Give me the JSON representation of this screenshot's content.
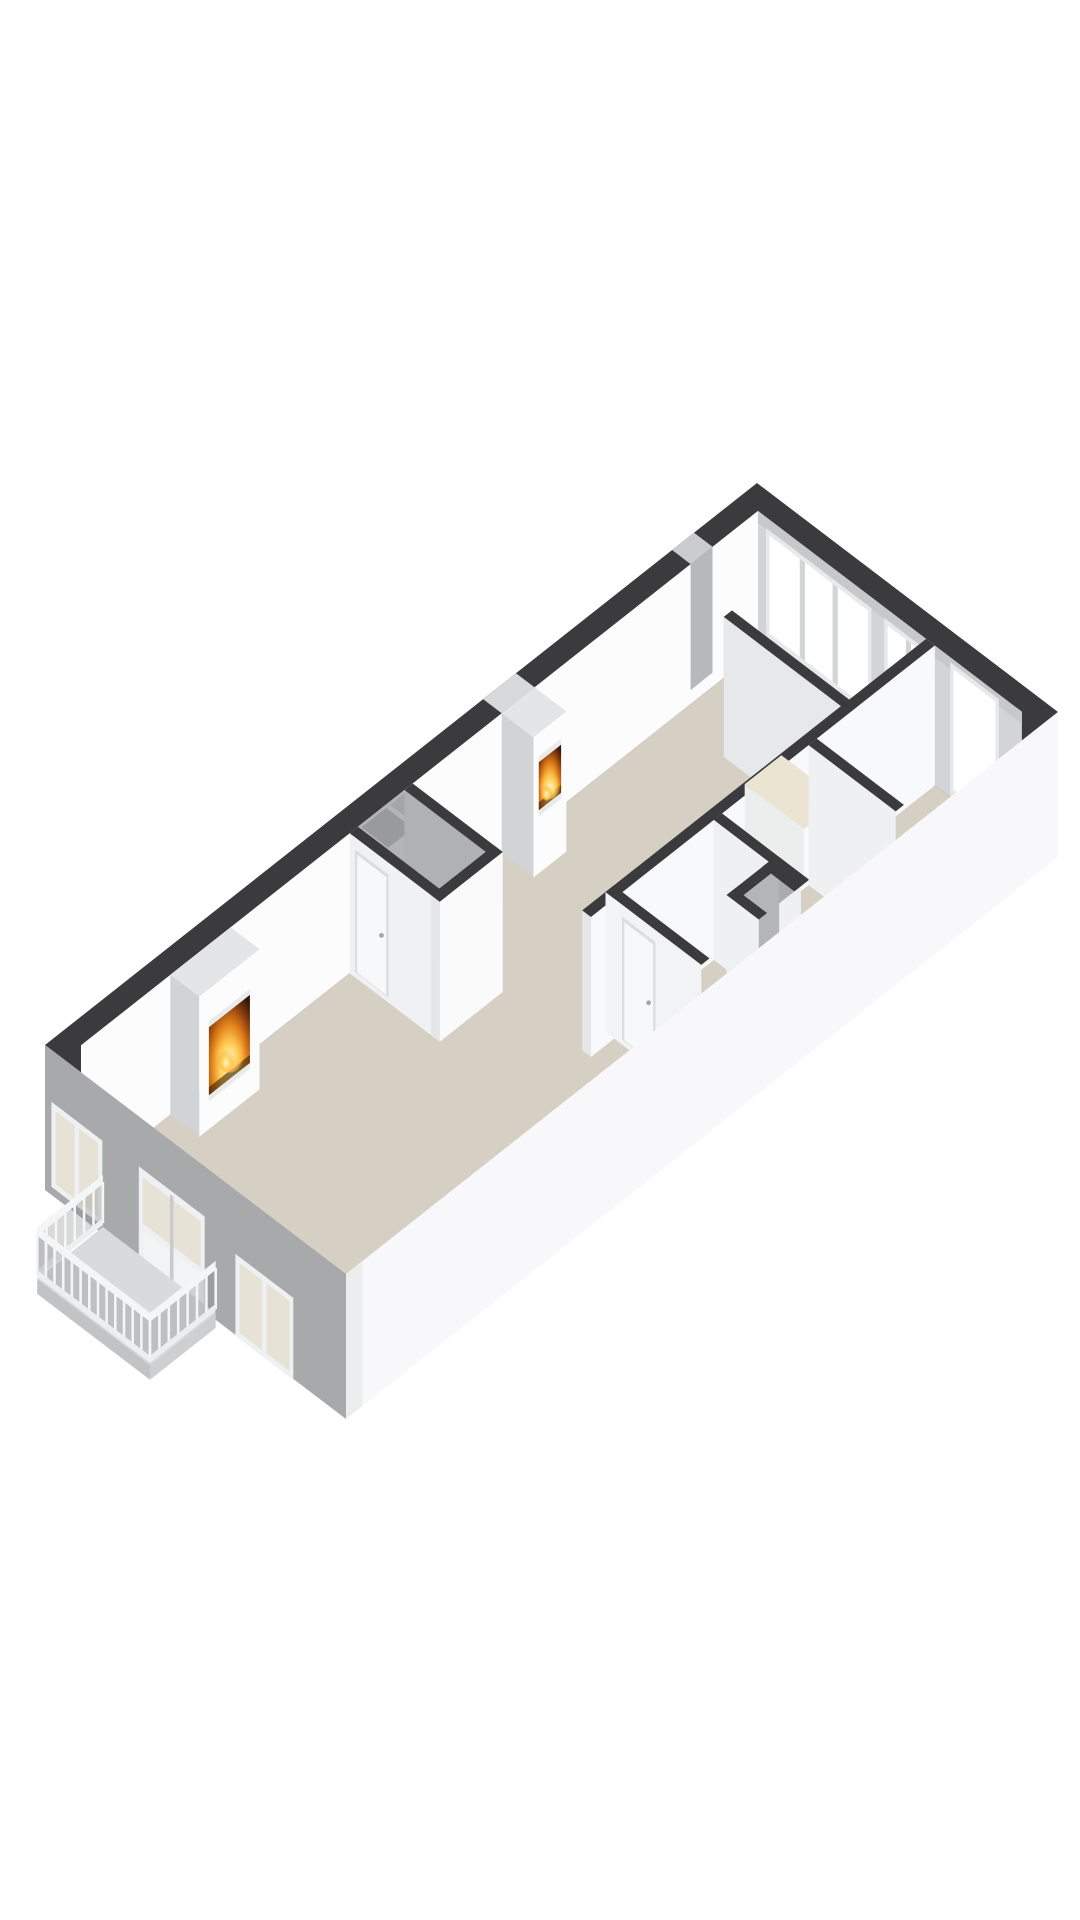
{
  "scene": {
    "kind": "3d-floorplan-cutaway-render",
    "background": "#ffffff"
  },
  "palette": {
    "background": "#ffffff",
    "wall_top": "#3b3b3d",
    "floor": "#d6d0c4",
    "wall_white": "#fcfcfd",
    "wall_shaded": "#d3d4d6",
    "wall_light": "#f0f1f3",
    "facade_sw": "#a8a9ab",
    "facade_se": "#f8f8fa",
    "glass_interior": "#ffffff",
    "glass_exterior": "#e7e2d6",
    "frame": "#eef0f1",
    "chimney_cap": "#e4e5e7",
    "chimney_side": "#d2d3d5",
    "counter_top": "#ebe4d2",
    "balcony_floor": "#d9dadc",
    "railing": "#f4f5f6",
    "shaft": "#aaabad",
    "door_leaf": "#f7f8f9",
    "handle": "#a6a7a9",
    "fire_core": "#ffd45e",
    "fire_mid": "#e07e18",
    "fire_deep": "#2e1507"
  },
  "features": {
    "fireplaces": 2,
    "interior_doors": 2,
    "ne_window_groups": 3,
    "sw_windows": 2,
    "sw_french_door_leaves": 2,
    "balcony": {
      "balusters_front": 13,
      "balusters_side": 7
    },
    "kitchen_counter_blocks": 1,
    "open_shafts": 2
  }
}
